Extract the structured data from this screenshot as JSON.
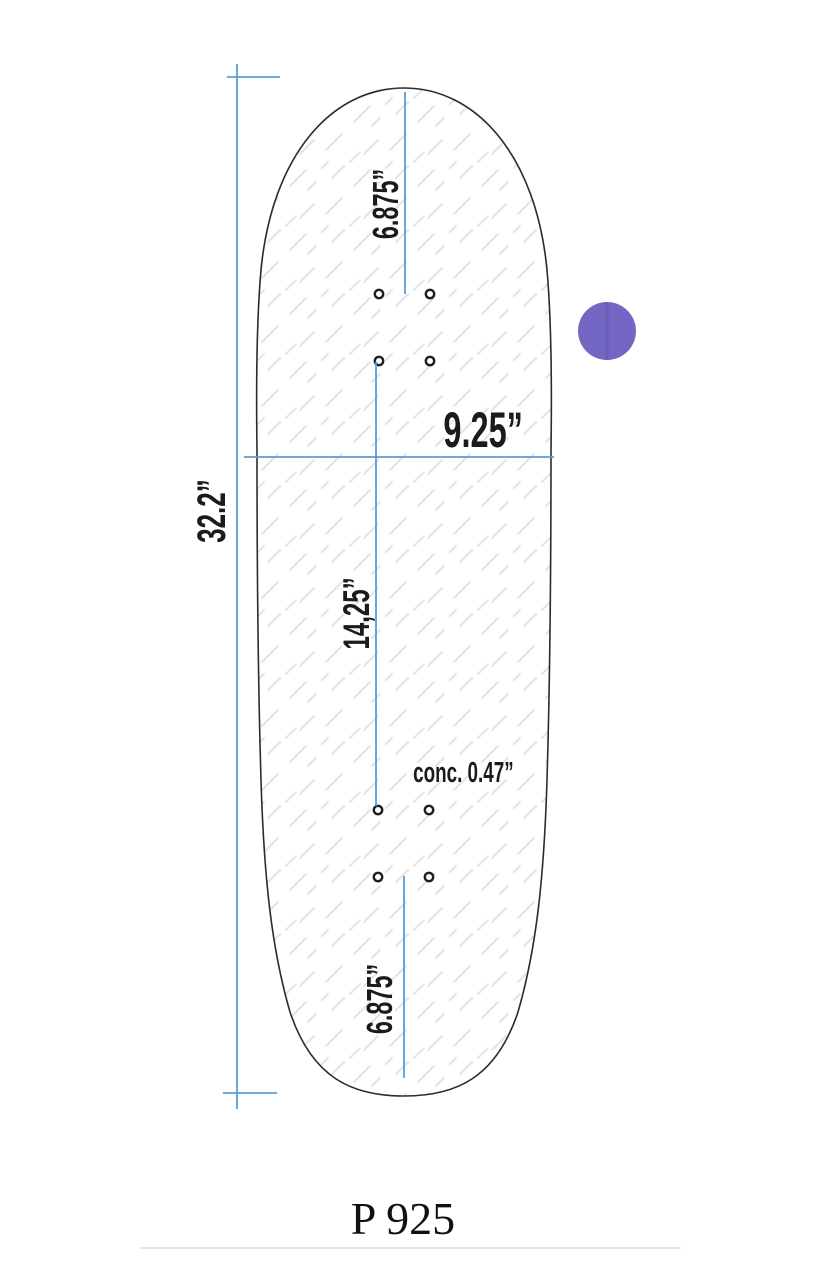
{
  "drawing": {
    "product_code": "P 925",
    "labels": {
      "length_total": "32.2”",
      "width": "9.25”",
      "nose_to_truck": "6.875”",
      "wheelbase": "14,25”",
      "concave": "conc. 0.47”",
      "tail_to_truck": "6.875”"
    },
    "colors": {
      "dimension_line": "#5b9bd5",
      "deck_outline": "#2b2b2b",
      "label_text": "#1b1b1b",
      "hatch_texture": "#e5e5e5",
      "swatch_purple": "#7367c3",
      "footer_divider": "#e4e4e4"
    },
    "icons": {
      "swatch": "purple-circle-color-swatch"
    }
  }
}
